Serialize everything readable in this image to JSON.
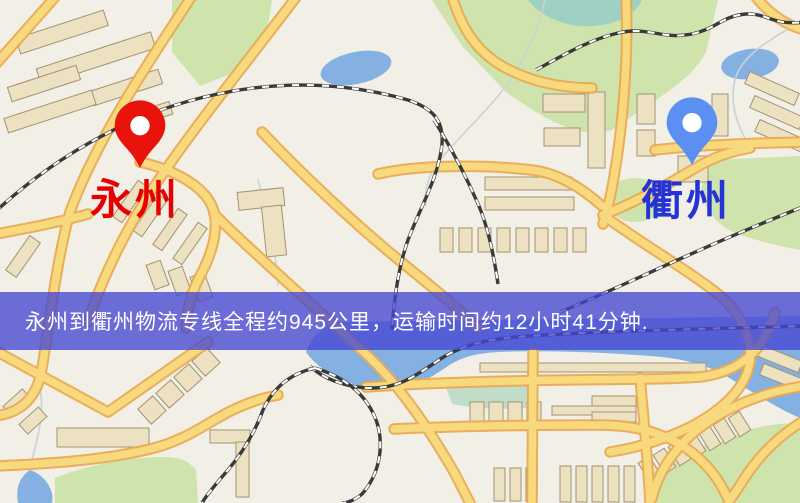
{
  "pins": {
    "origin": {
      "name": "永州",
      "pin_color": "#e8140c",
      "label_color": "#e60000"
    },
    "destination": {
      "name": "衢州",
      "pin_color": "#5b8ff2",
      "label_color": "#2433d6"
    }
  },
  "banner": {
    "text": "永州到衢州物流专线全程约945公里，运输时间约12小时41分钟.",
    "distance_text": "约945公里",
    "duration_text": "约12小时41分钟",
    "overlay_color": "rgba(70,70,210,0.78)",
    "background_hex": "#4646d2",
    "text_color": "#ffffff"
  },
  "icons": {
    "origin_pin": "map-pin",
    "destination_pin": "map-pin"
  },
  "map_palette": {
    "land": "#f2efe6",
    "park": "#cfe3ac",
    "park_teal": "#9ed0c4",
    "wetland": "#b9d8c2",
    "water": "#84b1e1",
    "stream": "#c9d2d8",
    "road_fill": "#f9d97e",
    "road_casing": "#e9ab52",
    "building_fill": "#ece1c1",
    "building_stroke": "#a39272",
    "railway": "#3a3a3a"
  }
}
